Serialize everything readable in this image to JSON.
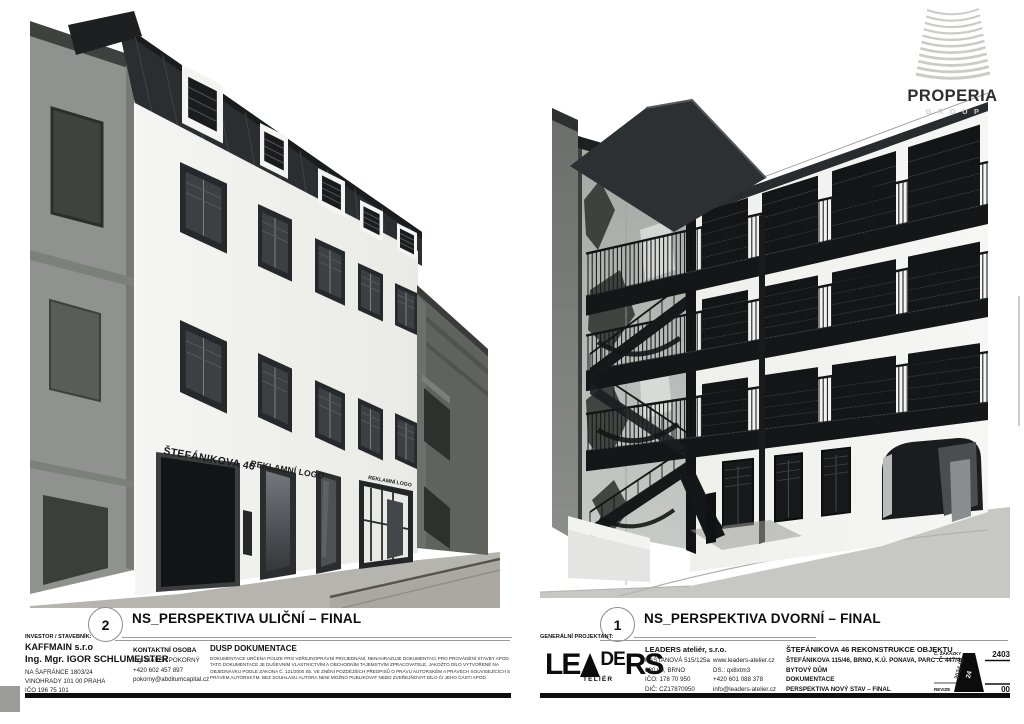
{
  "logo_properia": {
    "name": "PROPERIA",
    "subtitle": "GROUP"
  },
  "captions": {
    "left": {
      "number": "2",
      "title": "NS_PERSPEKTIVA ULIČNÍ – FINAL"
    },
    "right": {
      "number": "1",
      "title": "NS_PERSPEKTIVA DVORNÍ – FINAL"
    }
  },
  "renderings": {
    "left": {
      "facade_sign": "ŠTEFÁNIKOVA 46",
      "facade_ad": "REKLAMNÍ LOGO",
      "facade_ad_small": "REKLAMNÍ LOGO"
    }
  },
  "investor_block": {
    "label": "INVESTOR / STAVEBNÍK:",
    "company": "KAFFMAIN s.r.o",
    "person": "Ing. Mgr. IGOR SCHLUMEISTER",
    "address1": "NA ŠAFRÁNCE 1803/24",
    "address2": "VINOHRADY 101 00 PRAHA",
    "ico": "IČO 196 75 101",
    "contact_label": "KONTAKTNÍ OSOBA",
    "contact_name": "Ing. MAREK POKORNÝ",
    "contact_phone": "+420 602 457 897",
    "contact_email": "pokorny@abditumcapital.cz",
    "dusp_title": "DUSP DOKUMENTACE",
    "dusp_lines": [
      "DOKUMENTACE URČENA POUZE PRO VEŘEJNOPRÁVNÍ PROJEDNÁNÍ, NENAHRAZUJE DOKUMENTACI PRO PROVÁDĚNÍ STAVBY APOD.",
      "TATO DOKUMENTACE JE DUŠEVNÍM VLASTNICTVÍM A OBCHODNÍM TAJEMSTVÍM ZPRACOVATELE, JAKOŽTO DÍLO VYTVOŘENÉ NA",
      "OBJEDNÁVKU PODLE ZÁKONA Č. 121/2000 Sb. VE ZNĚNÍ POZDĚJŠÍCH PŘEDPISŮ O PRÁVU AUTORSKÉM A PRÁVECH SOUVISEJÍCÍCH S",
      "PRÁVEM AUTORSKÝM. BEZ SOUHLASU AUTORA NENÍ MOŽNO PUBLIKOVAT NEBO ZVEŘEJŇOVAT DÍLO ČI JEHO ČÁSTI APOD."
    ]
  },
  "projectant_block": {
    "label": "GENERÁLNÍ PROJEKTANT:",
    "logo": {
      "le": "LE",
      "de": "DE",
      "rs": "RS",
      "sub": "TELIÉR"
    },
    "company": "LEADERS ateliér, s.r.o.",
    "address": [
      "KAŠTANOVÁ 515/125a",
      "620 00, BRNO",
      "IČO: 178 70 950",
      "DIČ: CZ17870950"
    ],
    "contacts": [
      "www.leaders-atelier.cz",
      "DS.: qx8xtm3",
      "+420 601 088 378",
      "info@leaders-atelier.cz"
    ],
    "project_title": "ŠTEFÁNIKOVA 46 REKONSTRUKCE OBJEKTU",
    "project_lines": [
      "ŠTEFÁNIKOVA 115/46, BRNO, K.Ú. PONAVA, PARC .Č 447/4",
      "BYTOVÝ DŮM",
      "DOKUMENTACE",
      "PERSPEKTIVA NOVÝ STAV – FINAL"
    ],
    "stamp": {
      "zakazka_label": "Č. ZAKÁZKY",
      "zakazka_no": "2403",
      "date": "2024-05",
      "sheet_no": "24",
      "revize_label": "REVIZE",
      "revize_no": "00"
    }
  },
  "colors": {
    "accent_dark": "#1a1c1d",
    "facade_white": "#f3f3f1",
    "neighbor_gray": "#8f928e",
    "street_gray": "#b6b4af"
  }
}
